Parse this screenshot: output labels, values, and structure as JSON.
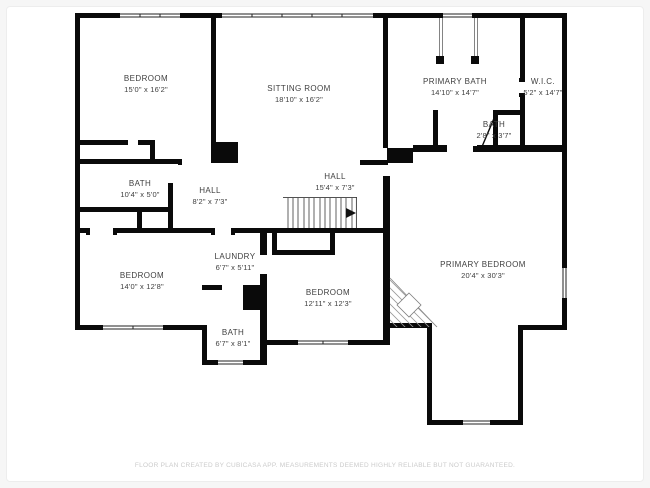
{
  "colors": {
    "wall": "#0a0a0a",
    "background": "#f6f6f6",
    "plan_background": "#ffffff",
    "label_text": "#3f3f3f",
    "footer_text": "#cbcbcb",
    "stair_line": "#3a3a3a",
    "hatch_line": "#9a9a9a"
  },
  "footer": {
    "text": "FLOOR PLAN CREATED BY CUBICASA APP. MEASUREMENTS DEEMED HIGHLY RELIABLE BUT NOT GUARANTEED."
  },
  "rooms": [
    {
      "name": "BEDROOM",
      "dims": "15'0\" x 16'2\"",
      "x": 146,
      "y": 84
    },
    {
      "name": "SITTING ROOM",
      "dims": "18'10\" x 16'2\"",
      "x": 299,
      "y": 94
    },
    {
      "name": "PRIMARY BATH",
      "dims": "14'10\" x 14'7\"",
      "x": 455,
      "y": 87
    },
    {
      "name": "W.I.C.",
      "dims": "5'2\" x 14'7\"",
      "x": 543,
      "y": 87
    },
    {
      "name": "BATH",
      "dims": "2'8\" x 3'7\"",
      "x": 494,
      "y": 130
    },
    {
      "name": "BATH",
      "dims": "10'4\" x 5'0\"",
      "x": 140,
      "y": 189
    },
    {
      "name": "HALL",
      "dims": "8'2\" x 7'3\"",
      "x": 210,
      "y": 196
    },
    {
      "name": "HALL",
      "dims": "15'4\" x 7'3\"",
      "x": 335,
      "y": 182
    },
    {
      "name": "LAUNDRY",
      "dims": "6'7\" x 5'11\"",
      "x": 235,
      "y": 262
    },
    {
      "name": "BEDROOM",
      "dims": "14'0\" x 12'8\"",
      "x": 142,
      "y": 281
    },
    {
      "name": "BATH",
      "dims": "6'7\" x 8'1\"",
      "x": 233,
      "y": 338
    },
    {
      "name": "BEDROOM",
      "dims": "12'11\" x 12'3\"",
      "x": 328,
      "y": 298
    },
    {
      "name": "PRIMARY BEDROOM",
      "dims": "20'4\" x 30'3\"",
      "x": 483,
      "y": 270
    }
  ]
}
